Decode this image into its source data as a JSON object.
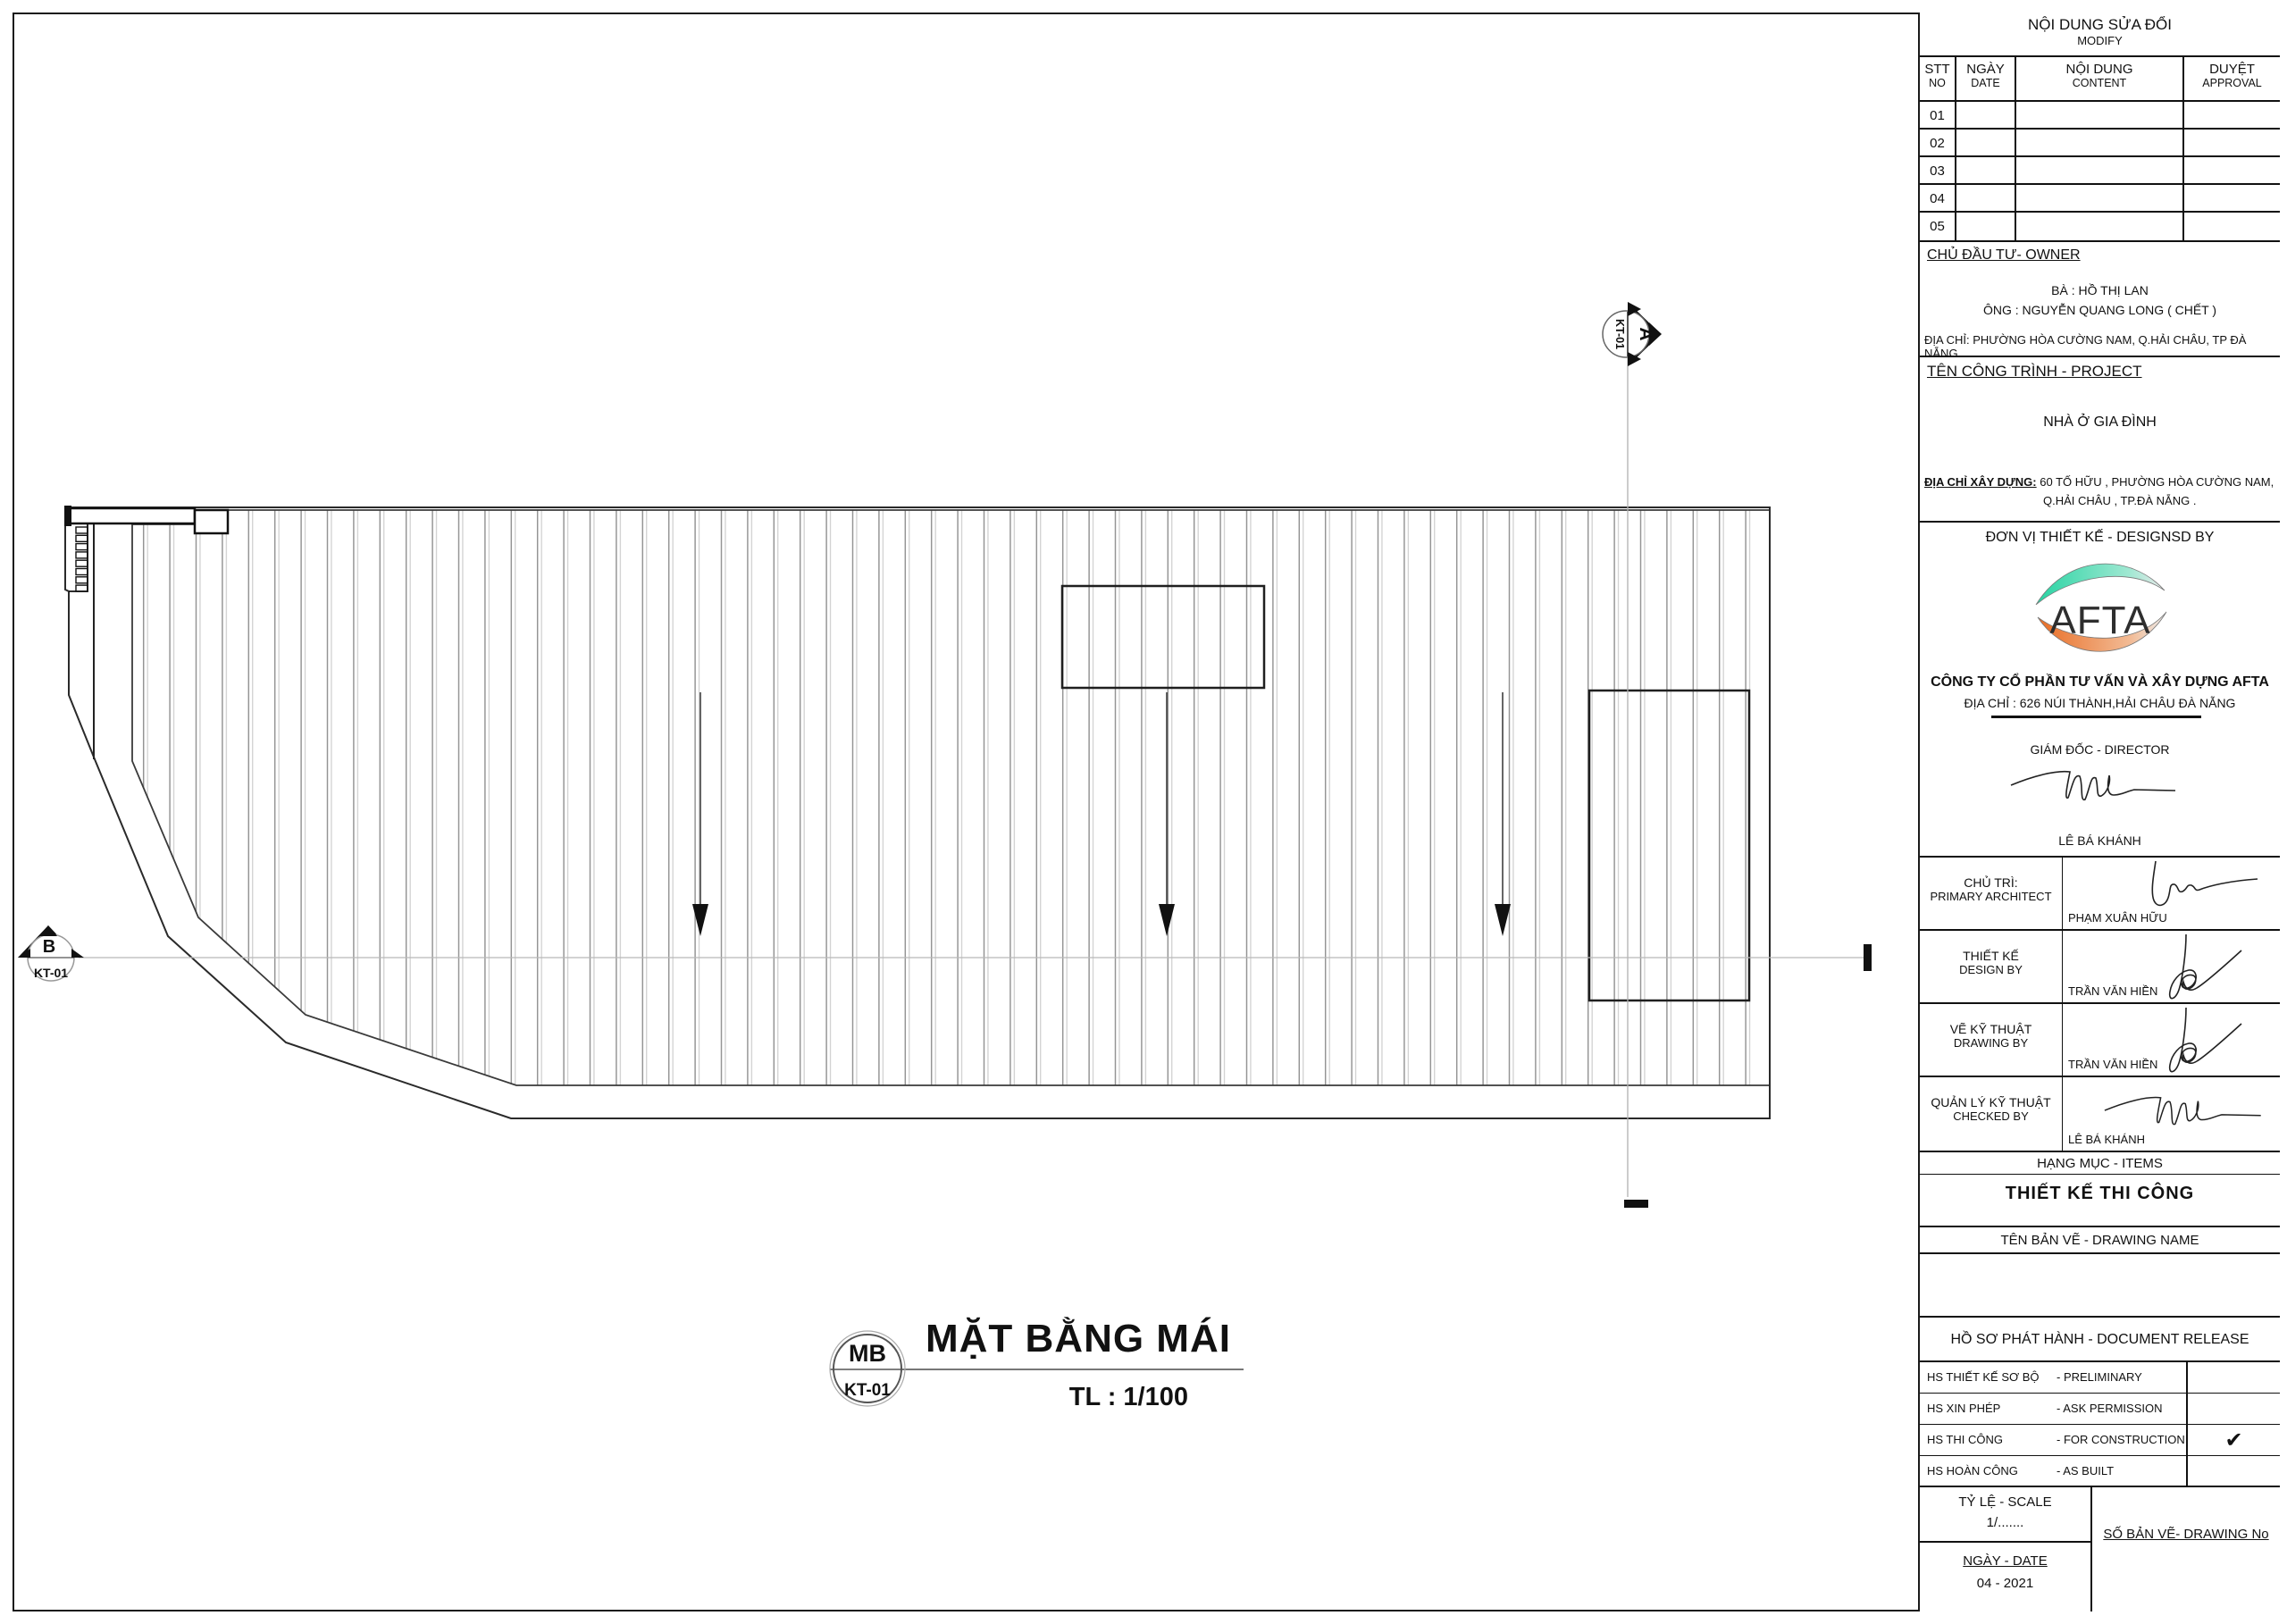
{
  "plan": {
    "title": "MẶT BẰNG MÁI",
    "scale": "TL : 1/100",
    "tag_top": "MB",
    "tag_bottom": "KT-01",
    "section_marker_a": {
      "letter": "A",
      "ref": "KT-01"
    },
    "section_marker_b": {
      "letter": "B",
      "ref": "KT-01"
    }
  },
  "title_block": {
    "modify": {
      "title_vi": "NỘI DUNG SỬA ĐỔI",
      "title_en": "MODIFY",
      "columns": [
        {
          "vi": "STT",
          "en": "NO"
        },
        {
          "vi": "NGÀY",
          "en": "DATE"
        },
        {
          "vi": "NỘI DUNG",
          "en": "CONTENT"
        },
        {
          "vi": "DUYỆT",
          "en": "APPROVAL"
        }
      ],
      "rows": [
        "01",
        "02",
        "03",
        "04",
        "05"
      ]
    },
    "owner": {
      "heading": "CHỦ ĐẦU TƯ- OWNER",
      "line1": "BÀ : HỒ THỊ LAN",
      "line2": "ÔNG : NGUYỄN QUANG LONG ( CHẾT )",
      "address_label": "ĐỊA CHỈ:",
      "address": "PHƯỜNG HÒA CƯỜNG NAM, Q.HẢI CHÂU, TP ĐÀ NẴNG."
    },
    "project": {
      "heading": "TÊN CÔNG TRÌNH - PROJECT",
      "name": "NHÀ Ở GIA ĐÌNH",
      "address_label": "ĐỊA CHỈ XÂY DỰNG:",
      "address_line1": "60 TỐ HỮU , PHƯỜNG HÒA CƯỜNG NAM,",
      "address_line2": "Q.HẢI CHÂU , TP.ĐÀ NẴNG ."
    },
    "designer": {
      "heading": "ĐƠN VỊ THIẾT KẾ - DESIGNSD BY",
      "logo_text": "AFTA",
      "company": "CÔNG TY CỔ PHẦN TƯ VẤN VÀ XÂY DỰNG AFTA",
      "address": "ĐỊA CHỈ : 626 NÚI THÀNH,HẢI CHÂU ĐÀ NẴNG",
      "director_label": "GIÁM ĐỐC - DIRECTOR",
      "director_name": "LÊ BÁ KHÁNH"
    },
    "signatories": [
      {
        "vi": "CHỦ TRÌ:",
        "en": "PRIMARY ARCHITECT",
        "name": "PHẠM XUÂN HỮU"
      },
      {
        "vi": "THIẾT KẾ",
        "en": "DESIGN BY",
        "name": "TRẦN VĂN HIỀN"
      },
      {
        "vi": "VẼ KỸ THUẬT",
        "en": "DRAWING BY",
        "name": "TRẦN VĂN HIỀN"
      },
      {
        "vi": "QUẢN LÝ KỸ THUẬT",
        "en": "CHECKED BY",
        "name": "LÊ BÁ KHÁNH"
      }
    ],
    "items": {
      "heading": "HẠNG MỤC - ITEMS",
      "value": "THIẾT KẾ  THI CÔNG"
    },
    "drawing_name": {
      "heading": "TÊN BẢN VẼ - DRAWING NAME",
      "value": ""
    },
    "release": {
      "heading": "HỒ SƠ PHÁT HÀNH - DOCUMENT RELEASE",
      "rows": [
        {
          "vi": "HS THIẾT KẾ SƠ BỘ",
          "en": "- PRELIMINARY",
          "mark": ""
        },
        {
          "vi": "HS XIN PHÉP",
          "en": "- ASK PERMISSION",
          "mark": ""
        },
        {
          "vi": "HS THI CÔNG",
          "en": "- FOR CONSTRUCTION",
          "mark": "✔"
        },
        {
          "vi": "HS HOÀN CÔNG",
          "en": "- AS BUILT",
          "mark": ""
        }
      ]
    },
    "footer": {
      "scale_label": "TỶ LỆ - SCALE",
      "scale_value": "1/.......",
      "date_label": "NGÀY - DATE",
      "date_value": "04 - 2021",
      "number_label": "SỐ BẢN VẼ- DRAWING No"
    }
  },
  "colors": {
    "logo_green": "#2fd3a5",
    "logo_orange": "#e9702a",
    "line_dark": "#1a1a1a",
    "hatch_dark": "#8f8f8f",
    "hatch_light": "#c9c9c9"
  }
}
